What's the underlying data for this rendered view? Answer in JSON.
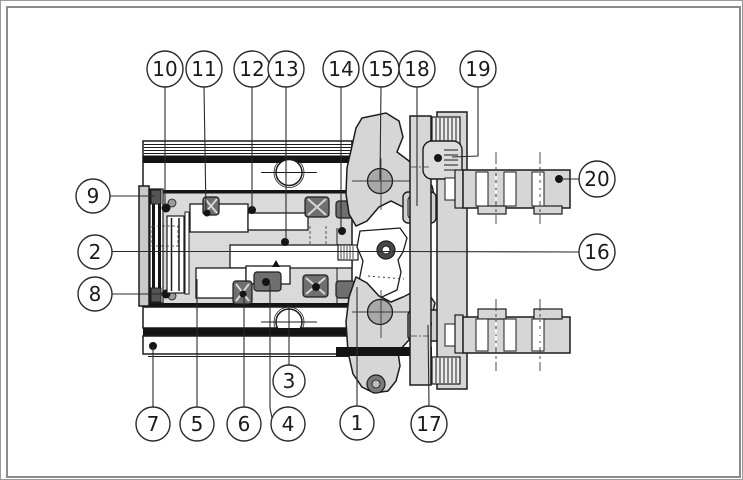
{
  "figure": {
    "type": "technical-diagram",
    "callouts": [
      {
        "label": "1",
        "cx": 357,
        "cy": 423,
        "r": 17,
        "leader": [
          [
            357,
            406
          ],
          [
            357,
            287
          ]
        ]
      },
      {
        "label": "2",
        "cx": 95,
        "cy": 252,
        "r": 17,
        "leader": [
          [
            112,
            251.5
          ],
          [
            390,
            251.5
          ]
        ]
      },
      {
        "label": "3",
        "cx": 289,
        "cy": 381,
        "r": 16,
        "leader": [
          [
            289,
            365
          ],
          [
            289,
            305
          ]
        ]
      },
      {
        "label": "4",
        "cx": 288,
        "cy": 424,
        "r": 17,
        "leader": [
          [
            272,
            418
          ],
          [
            270,
            408
          ],
          [
            270,
            284
          ]
        ]
      },
      {
        "label": "5",
        "cx": 197,
        "cy": 424,
        "r": 17,
        "leader": [
          [
            197,
            407
          ],
          [
            197,
            279
          ]
        ]
      },
      {
        "label": "6",
        "cx": 244,
        "cy": 424,
        "r": 17,
        "leader": [
          [
            244,
            407
          ],
          [
            244,
            296
          ]
        ]
      },
      {
        "label": "7",
        "cx": 153,
        "cy": 424,
        "r": 17,
        "leader": [
          [
            153,
            407
          ],
          [
            153,
            347
          ]
        ]
      },
      {
        "label": "8",
        "cx": 95,
        "cy": 294,
        "r": 17,
        "leader": [
          [
            112,
            294
          ],
          [
            164,
            294
          ]
        ]
      },
      {
        "label": "9",
        "cx": 93,
        "cy": 196,
        "r": 17,
        "leader": [
          [
            110,
            196
          ],
          [
            155,
            196
          ]
        ]
      },
      {
        "label": "10",
        "cx": 165,
        "cy": 69,
        "r": 18,
        "leader": [
          [
            165,
            87
          ],
          [
            165,
            206
          ]
        ]
      },
      {
        "label": "11",
        "cx": 204,
        "cy": 69,
        "r": 18,
        "leader": [
          [
            204,
            87
          ],
          [
            206,
            212
          ]
        ]
      },
      {
        "label": "12",
        "cx": 252,
        "cy": 69,
        "r": 18,
        "leader": [
          [
            252,
            87
          ],
          [
            252,
            209
          ]
        ]
      },
      {
        "label": "13",
        "cx": 286,
        "cy": 69,
        "r": 18,
        "leader": [
          [
            286,
            87
          ],
          [
            286,
            241
          ]
        ]
      },
      {
        "label": "14",
        "cx": 341,
        "cy": 69,
        "r": 18,
        "leader": [
          [
            341,
            87
          ],
          [
            341,
            229
          ]
        ]
      },
      {
        "label": "15",
        "cx": 381,
        "cy": 69,
        "r": 18,
        "leader": [
          [
            381,
            87
          ],
          [
            380,
            180
          ]
        ]
      },
      {
        "label": "16",
        "cx": 597,
        "cy": 252,
        "r": 18,
        "leader": [
          [
            579,
            252
          ],
          [
            392,
            251.5
          ]
        ]
      },
      {
        "label": "17",
        "cx": 429,
        "cy": 424,
        "r": 18,
        "leader": [
          [
            429,
            406
          ],
          [
            428,
            325
          ]
        ]
      },
      {
        "label": "18",
        "cx": 417,
        "cy": 69,
        "r": 18,
        "leader": [
          [
            417,
            87
          ],
          [
            417,
            206
          ]
        ]
      },
      {
        "label": "19",
        "cx": 478,
        "cy": 69,
        "r": 18,
        "leader": [
          [
            478,
            87
          ],
          [
            478,
            156
          ],
          [
            452,
            157
          ]
        ]
      },
      {
        "label": "20",
        "cx": 597,
        "cy": 179,
        "r": 18,
        "leader": [
          [
            579,
            179
          ],
          [
            561,
            179
          ]
        ]
      }
    ],
    "colors": {
      "ink": "#1c1c1c",
      "light_fill": "#d6d6d6",
      "mid_fill": "#a8a8a8",
      "dark_fill": "#6f6f6f",
      "frame": "#8c8c8c",
      "background": "#ffffff"
    }
  }
}
